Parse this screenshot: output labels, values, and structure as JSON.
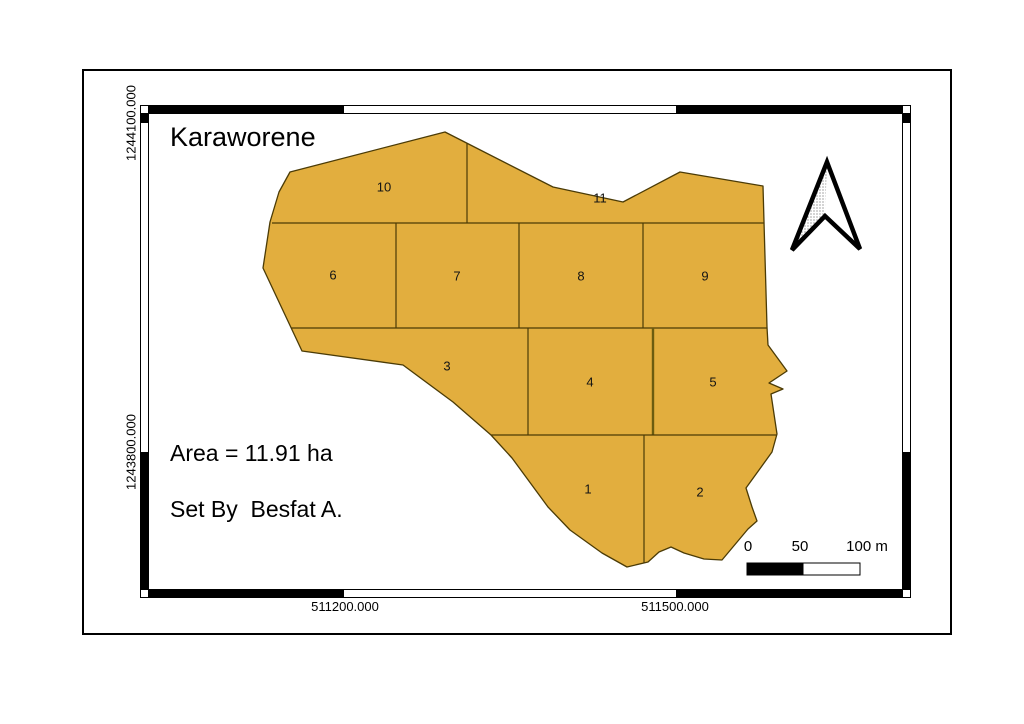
{
  "map": {
    "title": "Karaworene",
    "area_label": "Area = 11.91 ha",
    "credit_label": "Set By  Besfat A.",
    "colors": {
      "parcel_fill": "#e2ae3e",
      "parcel_stroke": "#4b3b06",
      "thick_divider_stroke": "#6b5c10",
      "frame_black": "#000000",
      "frame_white": "#ffffff"
    },
    "outline": [
      [
        445,
        132
      ],
      [
        553,
        187
      ],
      [
        623,
        202
      ],
      [
        680,
        172
      ],
      [
        763,
        186
      ],
      [
        764,
        222
      ],
      [
        767,
        327
      ],
      [
        768,
        345
      ],
      [
        787,
        371
      ],
      [
        769,
        383
      ],
      [
        783,
        389
      ],
      [
        771,
        394
      ],
      [
        777,
        434
      ],
      [
        772,
        452
      ],
      [
        746,
        488
      ],
      [
        752,
        507
      ],
      [
        757,
        521
      ],
      [
        748,
        529
      ],
      [
        722,
        560
      ],
      [
        704,
        559
      ],
      [
        684,
        553
      ],
      [
        671,
        547
      ],
      [
        659,
        552
      ],
      [
        648,
        562
      ],
      [
        627,
        567
      ],
      [
        602,
        553
      ],
      [
        570,
        530
      ],
      [
        548,
        507
      ],
      [
        512,
        458
      ],
      [
        491,
        435
      ],
      [
        453,
        402
      ],
      [
        403,
        365
      ],
      [
        302,
        351
      ],
      [
        263,
        268
      ],
      [
        270,
        222
      ],
      [
        279,
        192
      ],
      [
        290,
        172
      ]
    ],
    "internal_lines": [
      {
        "p1": [
          467,
          143
        ],
        "p2": [
          467,
          223
        ]
      },
      {
        "p1": [
          272,
          223
        ],
        "p2": [
          764,
          223
        ]
      },
      {
        "p1": [
          396,
          223
        ],
        "p2": [
          396,
          328
        ]
      },
      {
        "p1": [
          519,
          223
        ],
        "p2": [
          519,
          328
        ]
      },
      {
        "p1": [
          643,
          223
        ],
        "p2": [
          643,
          328
        ]
      },
      {
        "p1": [
          291,
          328
        ],
        "p2": [
          767,
          328
        ]
      },
      {
        "p1": [
          528,
          328
        ],
        "p2": [
          528,
          435
        ]
      },
      {
        "p1": [
          653,
          328
        ],
        "p2": [
          653,
          435
        ],
        "width": 2.4,
        "color": "#6b5c10"
      },
      {
        "p1": [
          491,
          435
        ],
        "p2": [
          777,
          435
        ]
      },
      {
        "p1": [
          644,
          435
        ],
        "p2": [
          644,
          563
        ]
      }
    ],
    "parcels": [
      {
        "label": "1",
        "x": 588,
        "y": 489
      },
      {
        "label": "2",
        "x": 700,
        "y": 492
      },
      {
        "label": "3",
        "x": 447,
        "y": 366
      },
      {
        "label": "4",
        "x": 590,
        "y": 382
      },
      {
        "label": "5",
        "x": 713,
        "y": 382
      },
      {
        "label": "6",
        "x": 333,
        "y": 275
      },
      {
        "label": "7",
        "x": 457,
        "y": 276
      },
      {
        "label": "8",
        "x": 581,
        "y": 276
      },
      {
        "label": "9",
        "x": 705,
        "y": 276
      },
      {
        "label": "10",
        "x": 384,
        "y": 187
      },
      {
        "label": "11",
        "x": 600,
        "y": 198
      }
    ]
  },
  "grid": {
    "left_labels": [
      {
        "text": "1244100.000",
        "x": 131,
        "y": 123
      },
      {
        "text": "1243800.000",
        "x": 131,
        "y": 452
      }
    ],
    "bottom_labels": [
      {
        "text": "511200.000",
        "x": 345,
        "y": 599
      },
      {
        "text": "511500.000",
        "x": 675,
        "y": 599
      }
    ]
  },
  "scalebar": {
    "labels": [
      {
        "text": "0",
        "x": 748
      },
      {
        "text": "50",
        "x": 800
      },
      {
        "text": "100 m",
        "x": 867
      }
    ],
    "label_top": 538
  },
  "north_arrow": {
    "icon": "north-arrow"
  }
}
